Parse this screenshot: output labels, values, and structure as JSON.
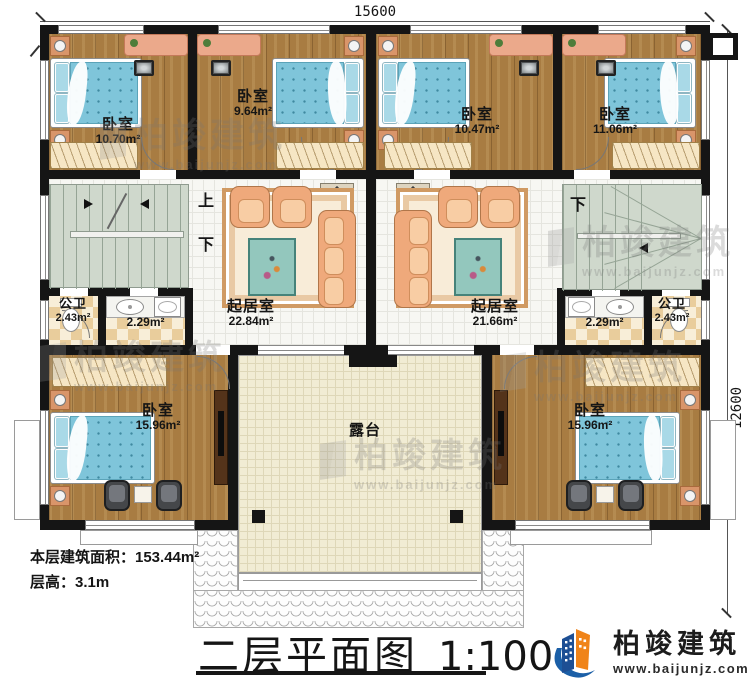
{
  "header": {
    "dim_top": "15600",
    "dim_right": "12600"
  },
  "rooms": {
    "bedroom_tl": {
      "label": "卧室",
      "area": "10.70m²"
    },
    "bedroom_tml": {
      "label": "卧室",
      "area": "9.64m²"
    },
    "bedroom_tmr": {
      "label": "卧室",
      "area": "10.47m²"
    },
    "bedroom_tr": {
      "label": "卧室",
      "area": "11.06m²"
    },
    "living_left": {
      "label": "起居室",
      "area": "22.84m²"
    },
    "living_right": {
      "label": "起居室",
      "area": "21.66m²"
    },
    "bath_left": {
      "label": "公卫",
      "area": "2.43m²"
    },
    "bath_right": {
      "label": "公卫",
      "area": "2.43m²"
    },
    "laundry_left": {
      "area": "2.29m²"
    },
    "laundry_right": {
      "area": "2.29m²"
    },
    "bedroom_bl": {
      "label": "卧室",
      "area": "15.96m²"
    },
    "bedroom_br": {
      "label": "卧室",
      "area": "15.96m²"
    },
    "terrace": {
      "label": "露台"
    }
  },
  "stairs": {
    "up": "上",
    "down": "下"
  },
  "notes": {
    "floor_area": "本层建筑面积：153.44m²",
    "floor_height": "层高：3.1m"
  },
  "titleblock": {
    "title": "二层平面图",
    "scale": "1:100"
  },
  "brand": {
    "name": "柏竣建筑",
    "url": "www.baijunjz.com"
  },
  "watermark": {
    "name": "柏竣建筑",
    "url": "www.baijunjz.com"
  }
}
